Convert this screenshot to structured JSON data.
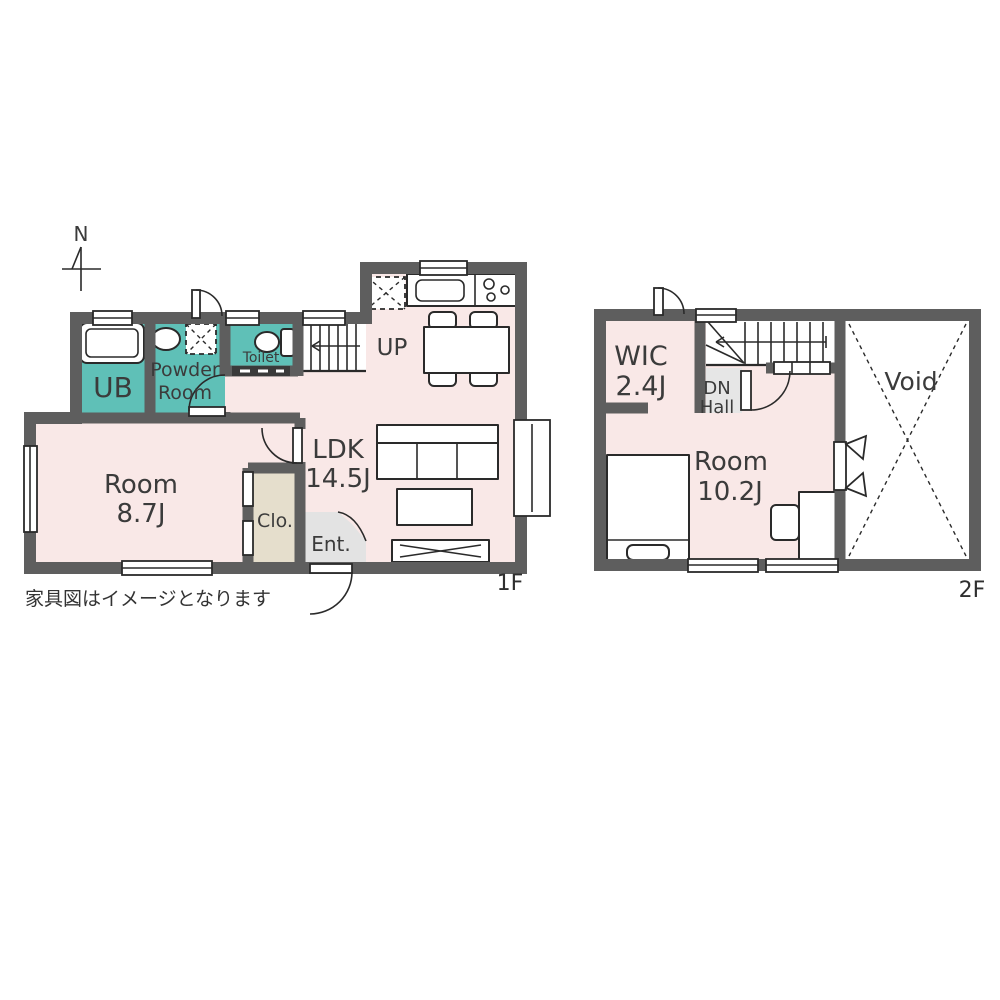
{
  "page": {
    "footnote": "家具図はイメージとなります"
  },
  "colors": {
    "wall": "#5e5e5e",
    "floor": "#f9e8e7",
    "wet_area": "#5fc0b7",
    "closet": "#e5decc",
    "entrance": "#e3e3e3",
    "hall": "#e6e6e6",
    "line": "#2a2a2a",
    "text": "#3b3b3b",
    "background": "#ffffff"
  },
  "compass": {
    "label": "N"
  },
  "floor_1f": {
    "tag": "1F",
    "rooms": {
      "ub": {
        "name": "UB"
      },
      "powder": {
        "line1": "Powder",
        "line2": "Room"
      },
      "toilet": {
        "name": "Toilet"
      },
      "stairs": {
        "direction": "UP"
      },
      "ldk": {
        "line1": "LDK",
        "line2": "14.5J"
      },
      "room": {
        "line1": "Room",
        "line2": "8.7J"
      },
      "closet": {
        "name": "Clo."
      },
      "entrance": {
        "name": "Ent."
      }
    }
  },
  "floor_2f": {
    "tag": "2F",
    "rooms": {
      "wic": {
        "line1": "WIC",
        "line2": "2.4J"
      },
      "hall": {
        "line1": "DN",
        "line2": "Hall"
      },
      "room": {
        "line1": "Room",
        "line2": "10.2J"
      },
      "void": {
        "name": "Void"
      }
    }
  }
}
